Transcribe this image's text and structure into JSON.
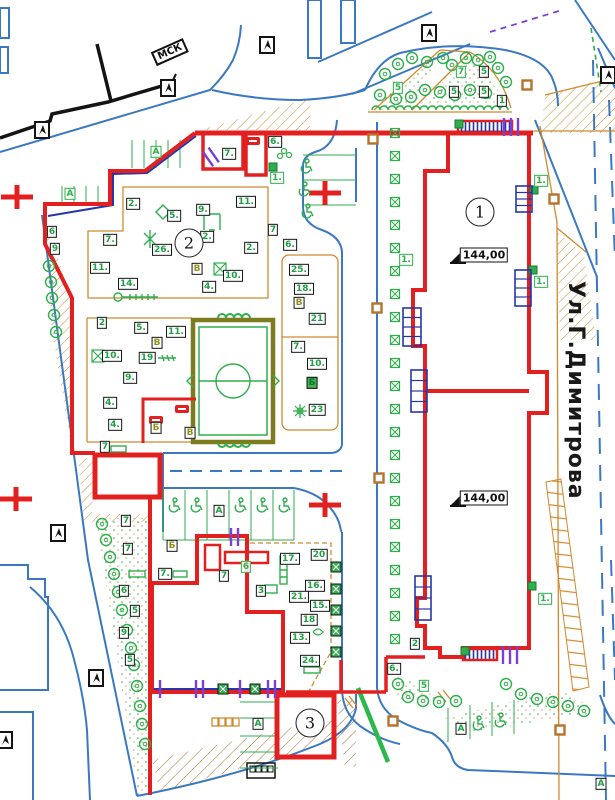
{
  "street": {
    "name": "Ул.Г.Димитрова"
  },
  "stamp": {
    "text": "МСК"
  },
  "colors": {
    "red": "#e32020",
    "green": "#2fae4c",
    "blue": "#3a79c2",
    "orange": "#cf8a2e",
    "navy": "#2636a8",
    "purple": "#7b3fd6",
    "olive": "#7c7c1e",
    "brown": "#a8702c"
  },
  "building_markers": [
    {
      "n": "1",
      "x": 480,
      "y": 212
    },
    {
      "n": "2",
      "x": 189,
      "y": 243
    },
    {
      "n": "3",
      "x": 310,
      "y": 723
    }
  ],
  "elevation_marks": [
    {
      "text": "144,00",
      "x": 484,
      "y": 255
    },
    {
      "text": "144,00",
      "x": 484,
      "y": 498
    }
  ],
  "labels": [
    {
      "t": "7.",
      "x": 229,
      "y": 154
    },
    {
      "t": "6.",
      "x": 275,
      "y": 142
    },
    {
      "t": "1.",
      "x": 277,
      "y": 178,
      "s": "gr"
    },
    {
      "t": "A",
      "x": 156,
      "y": 152,
      "s": "gr"
    },
    {
      "t": "A",
      "x": 70,
      "y": 194,
      "s": "gr"
    },
    {
      "t": "2.",
      "x": 133,
      "y": 204
    },
    {
      "t": "5.",
      "x": 174,
      "y": 216
    },
    {
      "t": "9.",
      "x": 203,
      "y": 210
    },
    {
      "t": "11.",
      "x": 246,
      "y": 202
    },
    {
      "t": "7",
      "x": 273,
      "y": 230
    },
    {
      "t": "2.",
      "x": 207,
      "y": 237
    },
    {
      "t": "2.",
      "x": 251,
      "y": 248
    },
    {
      "t": "6.",
      "x": 290,
      "y": 245
    },
    {
      "t": "26.",
      "x": 162,
      "y": 250
    },
    {
      "t": "7.",
      "x": 110,
      "y": 240
    },
    {
      "t": "11.",
      "x": 100,
      "y": 268
    },
    {
      "t": "14.",
      "x": 128,
      "y": 284
    },
    {
      "t": "В",
      "x": 197,
      "y": 269,
      "s": "ol"
    },
    {
      "t": "10.",
      "x": 233,
      "y": 276
    },
    {
      "t": "4.",
      "x": 209,
      "y": 287
    },
    {
      "t": "6",
      "x": 52,
      "y": 232
    },
    {
      "t": "9",
      "x": 55,
      "y": 249
    },
    {
      "t": "25.",
      "x": 299,
      "y": 270
    },
    {
      "t": "18.",
      "x": 304,
      "y": 289
    },
    {
      "t": "В",
      "x": 299,
      "y": 303,
      "s": "ol"
    },
    {
      "t": "21",
      "x": 317,
      "y": 319
    },
    {
      "t": "7.",
      "x": 298,
      "y": 347
    },
    {
      "t": "10.",
      "x": 317,
      "y": 364
    },
    {
      "t": "Б",
      "x": 312,
      "y": 383,
      "s": "gf"
    },
    {
      "t": "23",
      "x": 317,
      "y": 410
    },
    {
      "t": "2",
      "x": 102,
      "y": 323
    },
    {
      "t": "5.",
      "x": 141,
      "y": 328
    },
    {
      "t": "11.",
      "x": 176,
      "y": 332
    },
    {
      "t": "В",
      "x": 157,
      "y": 343,
      "s": "ol"
    },
    {
      "t": "10.",
      "x": 112,
      "y": 356
    },
    {
      "t": "19",
      "x": 147,
      "y": 358
    },
    {
      "t": "9.",
      "x": 130,
      "y": 378
    },
    {
      "t": "4.",
      "x": 110,
      "y": 403
    },
    {
      "t": "4.",
      "x": 115,
      "y": 425
    },
    {
      "t": "7",
      "x": 105,
      "y": 447
    },
    {
      "t": "Б",
      "x": 156,
      "y": 428,
      "s": "ol"
    },
    {
      "t": "В",
      "x": 190,
      "y": 433,
      "s": "ol"
    },
    {
      "t": "A",
      "x": 219,
      "y": 511
    },
    {
      "t": "Б",
      "x": 172,
      "y": 546,
      "s": "ol"
    },
    {
      "t": "7.",
      "x": 165,
      "y": 574
    },
    {
      "t": "7",
      "x": 224,
      "y": 576
    },
    {
      "t": "6",
      "x": 246,
      "y": 567,
      "s": "gr"
    },
    {
      "t": "3",
      "x": 261,
      "y": 591
    },
    {
      "t": "17.",
      "x": 290,
      "y": 559
    },
    {
      "t": "20",
      "x": 319,
      "y": 555
    },
    {
      "t": "16.",
      "x": 315,
      "y": 586
    },
    {
      "t": "21.",
      "x": 299,
      "y": 597
    },
    {
      "t": "15.",
      "x": 320,
      "y": 606
    },
    {
      "t": "18",
      "x": 309,
      "y": 620
    },
    {
      "t": "13.",
      "x": 300,
      "y": 638
    },
    {
      "t": "24.",
      "x": 310,
      "y": 661
    },
    {
      "t": "A",
      "x": 258,
      "y": 724
    },
    {
      "t": "6.",
      "x": 394,
      "y": 669
    },
    {
      "t": "5",
      "x": 424,
      "y": 686,
      "s": "gr"
    },
    {
      "t": "1.",
      "x": 406,
      "y": 260,
      "s": "gr"
    },
    {
      "t": "1.",
      "x": 541,
      "y": 181,
      "s": "gr"
    },
    {
      "t": "1.",
      "x": 541,
      "y": 282,
      "s": "gr"
    },
    {
      "t": "1.",
      "x": 545,
      "y": 599,
      "s": "gr"
    },
    {
      "t": "2",
      "x": 415,
      "y": 644
    },
    {
      "t": "A",
      "x": 461,
      "y": 729
    },
    {
      "t": "A",
      "x": 601,
      "y": 784
    },
    {
      "t": "7",
      "x": 461,
      "y": 72,
      "s": "gr"
    },
    {
      "t": "5",
      "x": 484,
      "y": 72
    },
    {
      "t": "5",
      "x": 454,
      "y": 92
    },
    {
      "t": "5",
      "x": 484,
      "y": 92
    },
    {
      "t": "5",
      "x": 398,
      "y": 88,
      "s": "gr"
    },
    {
      "t": "1",
      "x": 502,
      "y": 101
    },
    {
      "t": "7",
      "x": 126,
      "y": 521
    },
    {
      "t": "7",
      "x": 128,
      "y": 549
    },
    {
      "t": "6",
      "x": 124,
      "y": 591
    },
    {
      "t": "5",
      "x": 135,
      "y": 611
    },
    {
      "t": "9",
      "x": 124,
      "y": 633
    },
    {
      "t": "5",
      "x": 130,
      "y": 660
    }
  ],
  "geo": {
    "trees": [
      [
        385,
        74
      ],
      [
        398,
        64
      ],
      [
        412,
        58
      ],
      [
        427,
        62
      ],
      [
        443,
        58
      ],
      [
        452,
        65
      ],
      [
        466,
        58
      ],
      [
        478,
        60
      ],
      [
        490,
        57
      ],
      [
        498,
        68
      ],
      [
        506,
        82
      ],
      [
        486,
        93
      ],
      [
        470,
        90
      ],
      [
        455,
        95
      ],
      [
        440,
        92
      ],
      [
        425,
        90
      ],
      [
        411,
        97
      ],
      [
        396,
        99
      ],
      [
        380,
        95
      ],
      [
        49,
        266
      ],
      [
        51,
        282
      ],
      [
        52,
        298
      ],
      [
        54,
        315
      ],
      [
        56,
        332
      ],
      [
        102,
        524
      ],
      [
        106,
        540
      ],
      [
        110,
        557
      ],
      [
        114,
        574
      ],
      [
        118,
        592
      ],
      [
        122,
        610
      ],
      [
        127,
        630
      ],
      [
        131,
        648
      ],
      [
        134,
        665
      ],
      [
        137,
        686
      ],
      [
        140,
        706
      ],
      [
        142,
        724
      ],
      [
        145,
        744
      ],
      [
        398,
        684
      ],
      [
        408,
        697
      ],
      [
        423,
        701
      ],
      [
        439,
        702
      ],
      [
        456,
        701
      ],
      [
        506,
        684
      ],
      [
        521,
        694
      ],
      [
        537,
        699
      ],
      [
        553,
        702
      ],
      [
        568,
        706
      ],
      [
        584,
        711
      ]
    ],
    "hedge_row": {
      "x": 395,
      "y0": 133,
      "step": 23,
      "count": 23
    },
    "gates": [
      [
        336,
        567
      ],
      [
        336,
        589
      ],
      [
        336,
        610
      ],
      [
        336,
        631
      ],
      [
        336,
        652
      ],
      [
        223,
        689
      ],
      [
        255,
        689
      ]
    ],
    "green_squares": [
      [
        273,
        167
      ],
      [
        534,
        190
      ],
      [
        533,
        270
      ],
      [
        532,
        586
      ],
      [
        459,
        124
      ],
      [
        465,
        651
      ]
    ],
    "lamps": [
      [
        373,
        139
      ],
      [
        377,
        308
      ],
      [
        379,
        478
      ],
      [
        393,
        721
      ],
      [
        560,
        730
      ],
      [
        527,
        85
      ],
      [
        554,
        199
      ]
    ],
    "arrows": [
      [
        42,
        130
      ],
      [
        168,
        88
      ],
      [
        267,
        45
      ],
      [
        429,
        33
      ],
      [
        608,
        75
      ],
      [
        58,
        533
      ],
      [
        96,
        678
      ],
      [
        5,
        740
      ]
    ],
    "crosses": [
      [
        17,
        197
      ],
      [
        325,
        193
      ],
      [
        16,
        499
      ],
      [
        325,
        505
      ]
    ],
    "wheelchairs": [
      [
        174,
        505
      ],
      [
        196,
        505
      ],
      [
        240,
        505
      ],
      [
        262,
        505
      ],
      [
        284,
        505
      ],
      [
        306,
        166
      ],
      [
        304,
        189
      ],
      [
        307,
        211
      ],
      [
        478,
        723
      ],
      [
        500,
        720
      ]
    ],
    "purple_ticks": [
      {
        "x": 208,
        "y": 159,
        "rot": -35,
        "n": 2
      },
      {
        "x": 231,
        "y": 537,
        "rot": 0,
        "n": 2
      },
      {
        "x": 160,
        "y": 689,
        "rot": 0,
        "n": 1
      },
      {
        "x": 196,
        "y": 689,
        "rot": 0,
        "n": 2
      },
      {
        "x": 240,
        "y": 689,
        "rot": 0,
        "n": 1
      },
      {
        "x": 268,
        "y": 689,
        "rot": 0,
        "n": 2
      },
      {
        "x": 504,
        "y": 127,
        "rot": 0,
        "n": 3
      },
      {
        "x": 503,
        "y": 655,
        "rot": 0,
        "n": 3
      }
    ],
    "stairs": [
      [
        403,
        308,
        18,
        38
      ],
      [
        411,
        370,
        16,
        42
      ],
      [
        415,
        576,
        16,
        44
      ],
      [
        516,
        186,
        16,
        26
      ],
      [
        515,
        270,
        16,
        36
      ]
    ]
  }
}
